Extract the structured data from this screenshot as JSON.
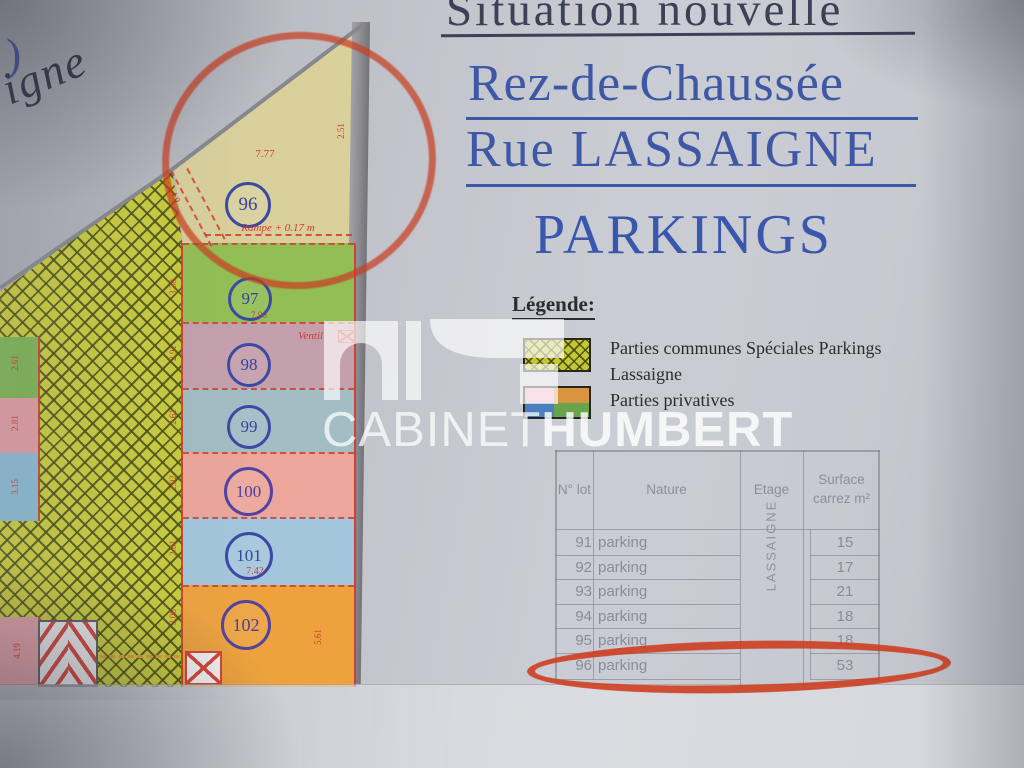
{
  "titles": {
    "top": "Situation nouvelle",
    "line1": "Rez-de-Chaussée",
    "line2": "Rue LASSAIGNE",
    "line3": "PARKINGS"
  },
  "corner": {
    "bracket": ")",
    "street_fragment": "igne"
  },
  "legend": {
    "heading": "Légende:",
    "item1_line1": "Parties communes Spéciales Parkings",
    "item1_line2": "Lassaigne",
    "item2": "Parties privatives"
  },
  "watermark": {
    "name1": "CABINET",
    "name2": "HUMBERT"
  },
  "table": {
    "headers": {
      "lot": "N° lot",
      "nature": "Nature",
      "etage": "Etage",
      "surface_l1": "Surface",
      "surface_l2": "carrez m²"
    },
    "etage_value": "LASSAIGNE",
    "rows": [
      {
        "lot": "91",
        "nature": "parking",
        "surface": "15"
      },
      {
        "lot": "92",
        "nature": "parking",
        "surface": "17"
      },
      {
        "lot": "93",
        "nature": "parking",
        "surface": "21"
      },
      {
        "lot": "94",
        "nature": "parking",
        "surface": "18"
      },
      {
        "lot": "95",
        "nature": "parking",
        "surface": "18"
      },
      {
        "lot": "96",
        "nature": "parking",
        "surface": "53"
      }
    ]
  },
  "plan": {
    "lot96": {
      "num": "96",
      "area_dim": "7.77",
      "right_dim": "2.51",
      "ramp_label": "Rampe + 0.17 m",
      "ramp_dim": "4.0"
    },
    "strips": [
      {
        "num": "97",
        "left_dim": "3.30",
        "bottom_dim": "7.90"
      },
      {
        "num": "98",
        "left_dim": "2.91",
        "note": "Ventil"
      },
      {
        "num": "99",
        "left_dim": "2.61"
      },
      {
        "num": "100",
        "left_dim": "2.92"
      },
      {
        "num": "101",
        "left_dim": "2.61",
        "bottom_dim": "7.42"
      },
      {
        "num": "102",
        "left_dim": "3.06",
        "right_dim": "5.61"
      }
    ],
    "edge_strips": [
      {
        "dim": "2.61"
      },
      {
        "dim": "2.81"
      },
      {
        "dim": "3.15"
      },
      {
        "dim": "4.19"
      }
    ]
  },
  "colors": {
    "title_blue": "#3f58a6",
    "title_dark": "#3c4156",
    "hatch_yellow": "#c9cd3c",
    "lot96_tan": "#d9d09c",
    "lot97_green": "#92bf55",
    "lot98_mauve": "#c4a0ac",
    "lot99_bluegray": "#a2bdc4",
    "lot100_salmon": "#eca69b",
    "lot101_blue": "#a3c6dc",
    "lot102_orange": "#eda23e",
    "annotation_red": "#cd3a1c",
    "dim_red": "#cf3a30",
    "circle_blue": "#3b49a4"
  }
}
